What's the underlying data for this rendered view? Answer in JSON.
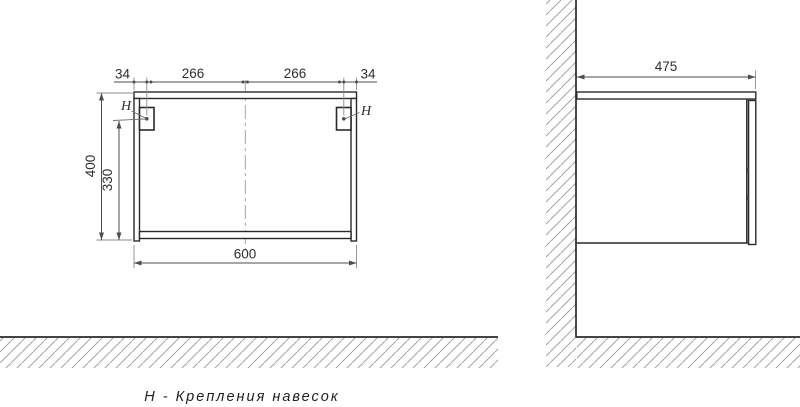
{
  "front_view": {
    "dim_top_left_margin": "34",
    "dim_top_left_span": "266",
    "dim_top_right_span": "266",
    "dim_top_right_margin": "34",
    "dim_height": "400",
    "dim_mount_height": "330",
    "dim_width": "600",
    "mount_left_label": "H",
    "mount_right_label": "H"
  },
  "side_view": {
    "dim_depth": "475"
  },
  "caption": "Н - Крепления навесок",
  "colors": {
    "line": "#2a2a2a",
    "dim_line": "#4d4d4d",
    "text": "#2f2f2f",
    "hatch": "#a3a3a3",
    "centerline": "#9c9c9c"
  }
}
